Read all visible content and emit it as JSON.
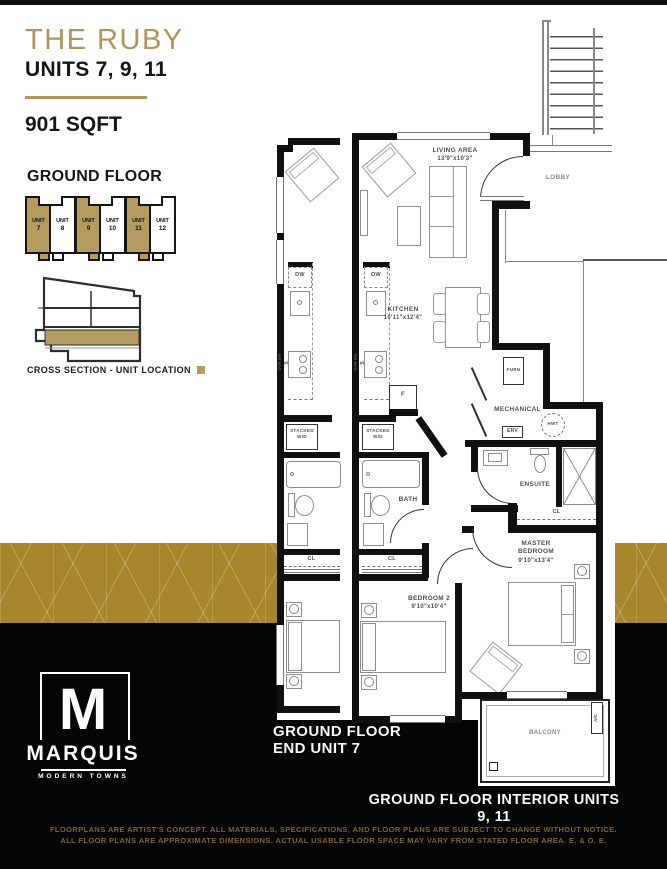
{
  "page": {
    "title": "THE RUBY",
    "subtitle": "UNITS 7, 9, 11",
    "area": "901 SQFT"
  },
  "location_key": {
    "heading": "GROUND FLOOR",
    "units": [
      {
        "label": "UNIT",
        "num": "7",
        "highlighted": true
      },
      {
        "label": "UNIT",
        "num": "8",
        "highlighted": false
      },
      {
        "label": "UNIT",
        "num": "9",
        "highlighted": true
      },
      {
        "label": "UNIT",
        "num": "10",
        "highlighted": false
      },
      {
        "label": "UNIT",
        "num": "11",
        "highlighted": true
      },
      {
        "label": "UNIT",
        "num": "12",
        "highlighted": false
      }
    ],
    "cross_section_label": "CROSS SECTION - UNIT LOCATION"
  },
  "plan": {
    "living": {
      "name": "LIVING AREA",
      "dims": "13'9\"x10'3\""
    },
    "kitchen": {
      "name": "KITCHEN",
      "dims": "10'11\"x12'4\""
    },
    "master": {
      "l1": "MASTER",
      "l2": "BEDROOM",
      "dims": "9'10\"x13'4\""
    },
    "bedroom2": {
      "name": "BEDROOM 2",
      "dims": "9'10\"x10'4\""
    },
    "lobby": "LOBBY",
    "bath": "BATH",
    "ensuite": "ENSUITE",
    "mechanical": "MECHANICAL",
    "furn": "FURN",
    "erv": "ERV",
    "hwt": "HWT",
    "fridge": "F",
    "dw": "DW",
    "stove": "S",
    "otr": "OTR MV",
    "wd1": "STACKED",
    "wd2": "W/D",
    "cl": "CL",
    "balcony": "BALCONY",
    "ac": "A/C"
  },
  "captions": {
    "end_l1": "GROUND FLOOR",
    "end_l2": "END UNIT 7",
    "interior": "GROUND FLOOR INTERIOR UNITS 9, 11"
  },
  "logo": {
    "monogram": "M",
    "name": "MARQUIS",
    "tagline": "MODERN TOWNS"
  },
  "disclaimer": {
    "l1": "FLOORPLANS ARE ARTIST'S CONCEPT. ALL MATERIALS, SPECIFICATIONS, AND FLOOR PLANS ARE SUBJECT TO CHANGE WITHOUT NOTICE.",
    "l2": "ALL FLOOR PLANS ARE APPROXIMATE DIMENSIONS. ACTUAL USABLE FLOOR SPACE MAY VARY FROM STATED FLOOR AREA. E. & O. E."
  },
  "colors": {
    "gold": "#b2935a",
    "band_gold": "#a8862d",
    "unit_tan": "#b49b60",
    "black": "#050505",
    "disclaimer_gold": "#7b6530"
  }
}
